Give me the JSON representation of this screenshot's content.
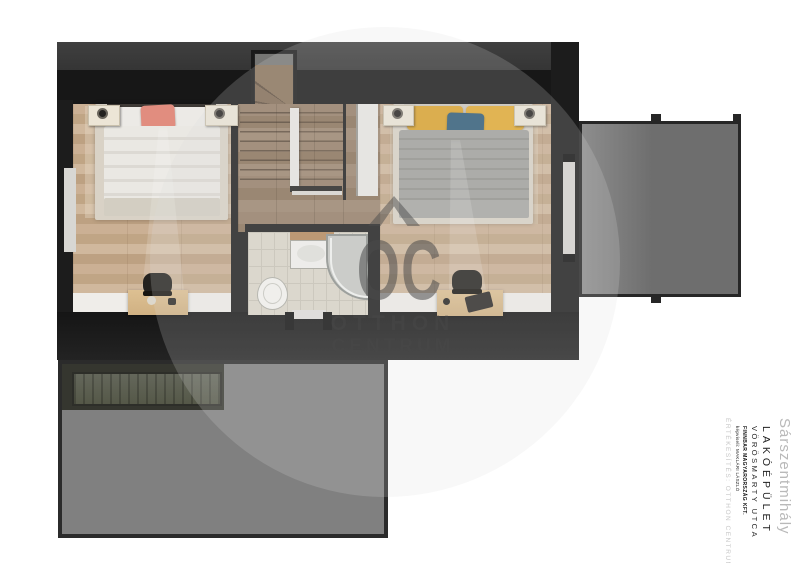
{
  "watermark": {
    "logo_letters": "OC",
    "line1": "OTTHON",
    "line2": "CENTRUM"
  },
  "title_block": {
    "location": "Sárszentmihály",
    "building_type": "LAKÓÉPÜLET",
    "street": "VÖRÖSMARTY UTCA",
    "company": "FINNBAR MAGYARORSZÁG KFT.",
    "company_detail": "képviseli: MAKLÁRI LÁSZLÓ",
    "sales_label": "ÉRTÉKESÍTÉS: OTTHON CENTRUM"
  },
  "colors": {
    "wall_dark": "#1c1c1c",
    "roof_gray": "#3a3a3a",
    "wood_light": "#c7ac8f",
    "wood_stairs": "#8f785f",
    "tile_light": "#dbd6ca",
    "terrace_gray": "#808080",
    "balcony_gray": "#6f6f6f",
    "pillow_pink": "#e18d7f",
    "pillow_yellow": "#dda32d",
    "pillow_blue": "#2d5b77",
    "desk_tan": "#d7ba8c",
    "watermark_gray": "#6a6a6a"
  }
}
